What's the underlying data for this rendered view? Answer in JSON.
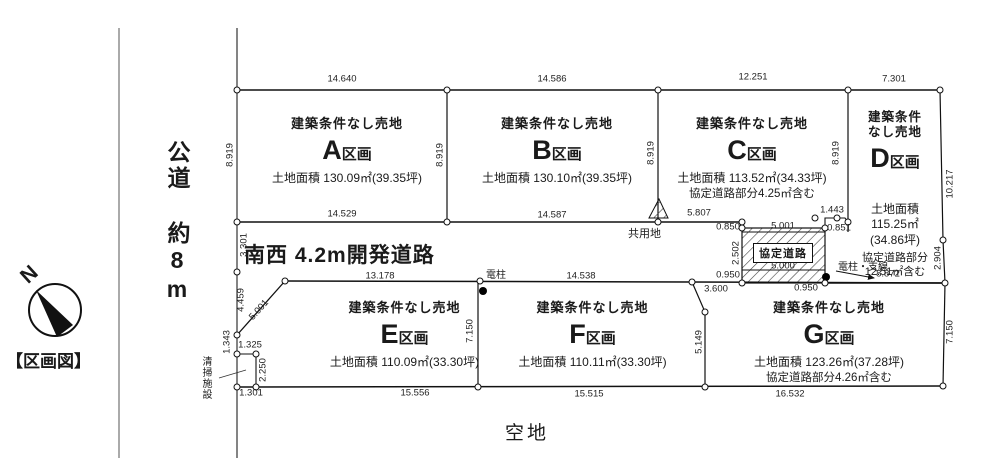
{
  "map_title": "【区画図】",
  "compass": {
    "north": "N"
  },
  "labels": {
    "public_road": "公道 約8m",
    "dev_road": "南西 4.2m開発道路",
    "agreement_road": "協定道路",
    "common_area": "共用地",
    "vacant_land": "空地",
    "pole": "電柱",
    "pole_wire": "電柱・支線",
    "cleaning_facility": "清掃施設"
  },
  "plots": {
    "a": {
      "letter": "A",
      "ku": "区画",
      "sale": "建築条件なし売地",
      "area": "土地面積 130.09㎡(39.35坪)"
    },
    "b": {
      "letter": "B",
      "ku": "区画",
      "sale": "建築条件なし売地",
      "area": "土地面積 130.10㎡(39.35坪)"
    },
    "c": {
      "letter": "C",
      "ku": "区画",
      "sale": "建築条件なし売地",
      "area": "土地面積 113.52㎡(34.33坪)",
      "note": "協定道路部分4.25㎡含む"
    },
    "d": {
      "letter": "D",
      "ku": "区画",
      "sale1": "建築条件",
      "sale2": "なし売地",
      "area1": "土地面積",
      "area2": "115.25㎡",
      "area3": "(34.86坪)",
      "note1": "協定道路部分",
      "note2": "12.51㎡含む"
    },
    "e": {
      "letter": "E",
      "ku": "区画",
      "sale": "建築条件なし売地",
      "area": "土地面積 110.09㎡(33.30坪)"
    },
    "f": {
      "letter": "F",
      "ku": "区画",
      "sale": "建築条件なし売地",
      "area": "土地面積 110.11㎡(33.30坪)"
    },
    "g": {
      "letter": "G",
      "ku": "区画",
      "sale": "建築条件なし売地",
      "area": "土地面積 123.26㎡(37.28坪)",
      "note": "協定道路部分4.26㎡含む"
    }
  },
  "dims": {
    "top_a": "14.640",
    "top_b": "14.586",
    "top_c": "12.251",
    "top_d": "7.301",
    "a_left": "8.919",
    "ab": "8.919",
    "bc": "8.919",
    "c_right": "8.919",
    "d_right_upper": "10.217",
    "d_right_lower": "2.904",
    "a_bottom": "14.529",
    "b_bottom": "14.587",
    "c_bottom": "5.807",
    "c_step": "1.443",
    "road_left_upper": "3.301",
    "road_left_lower": "4.459",
    "e_diag": "5.001",
    "e_left": "1.343",
    "notch_top": "1.325",
    "notch_right": "2.250",
    "notch_bottom": "1.301",
    "e_top": "13.178",
    "f_top": "14.538",
    "e_bottom": "15.556",
    "f_bottom": "15.515",
    "g_bottom": "16.532",
    "ef": "7.150",
    "fg": "5.149",
    "g_right": "7.150",
    "g_top": "3.600",
    "hatch_tl": "0.850",
    "hatch_top": "5.001",
    "hatch_tr": "0.851",
    "hatch_left": "2.502",
    "hatch_bot": "5.000",
    "hatch_bl": "0.950",
    "hatch_br": "0.950",
    "d_bottom": "8.872"
  }
}
